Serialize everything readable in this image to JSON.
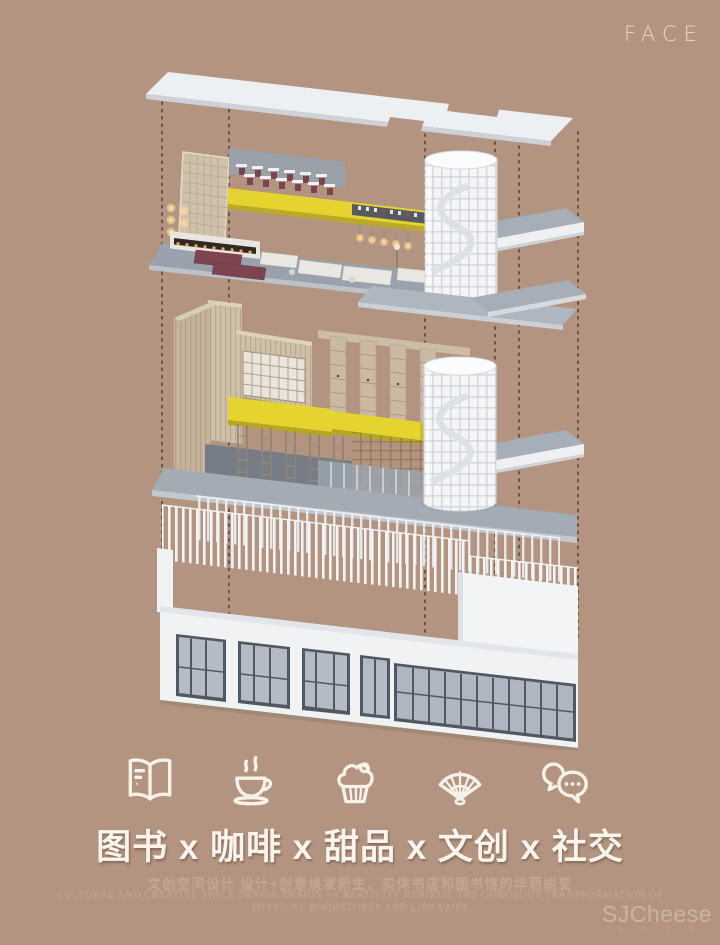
{
  "page": {
    "background": "#b29480"
  },
  "brand": {
    "logo": "FACE",
    "tagline": "· · · ·  · · · · · · ·"
  },
  "model": {
    "accent_yellow": "#e6d42e",
    "slab_white": "#eef1f4",
    "floor_gray": "#9aa3ad",
    "wood_tan": "#c6b39c",
    "seat_burgundy": "#7d4450",
    "construction_line_brown": "#5d4836",
    "icon_names": [
      "roof-slab",
      "level-3-interior",
      "spiral-staircase-upper",
      "level-2-interior",
      "spiral-staircase-lower",
      "level-1-exterior",
      "construction-lines"
    ]
  },
  "features": {
    "icons": [
      {
        "name": "book-icon"
      },
      {
        "name": "coffee-icon"
      },
      {
        "name": "cupcake-icon"
      },
      {
        "name": "fan-icon"
      },
      {
        "name": "chat-icon"
      }
    ],
    "title": "图书 x 咖啡 x 甜品 x 文创 x 社交"
  },
  "subtitle": {
    "cn": "文创空间设计 设计+创意焕发新生，实体书店和图书馆的华丽蜕变",
    "en1": "CULTURAL AND CREATIVE SPACE DESIGN DESIGN + CREATIVITY REBIRTH, THE GORGEOUS TRANSFORMATION OF",
    "en2": "PHYSICAL BOOKSTORES AND LIBRARIES"
  },
  "watermark": {
    "text": "SJCheese",
    "sub": "9 0 2 1"
  }
}
